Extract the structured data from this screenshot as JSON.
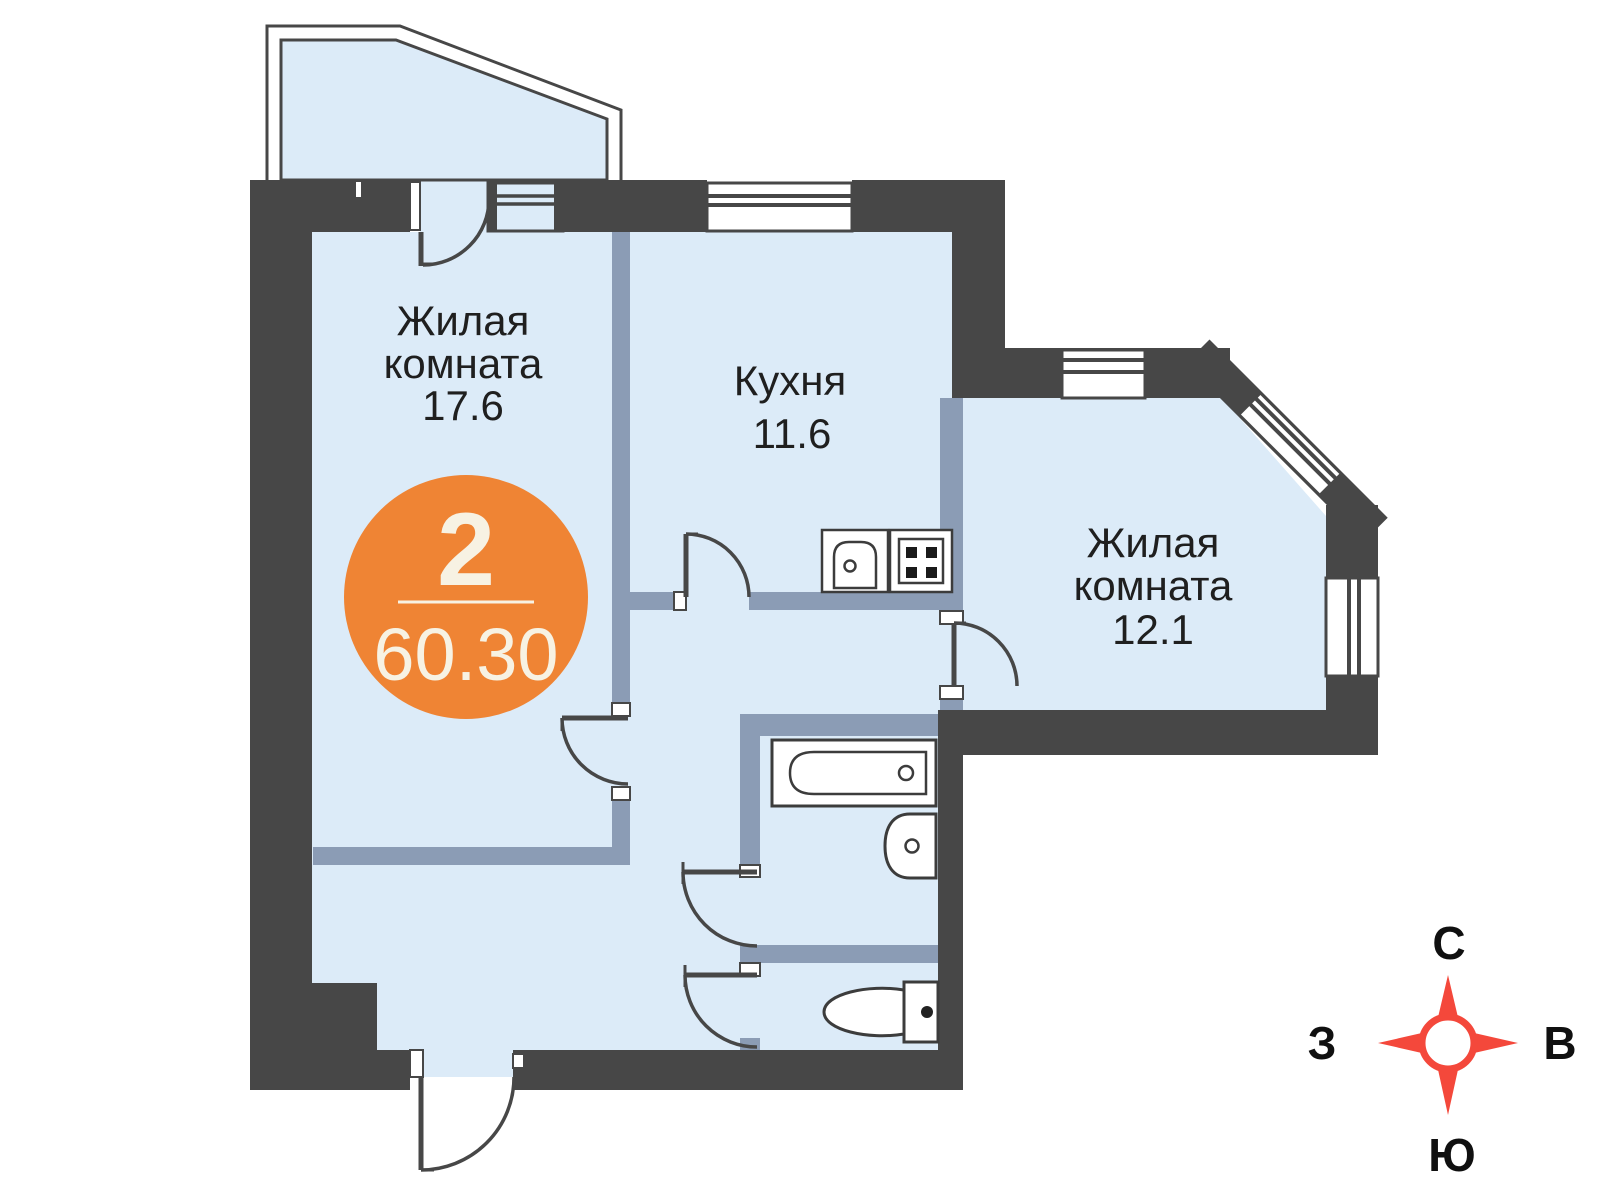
{
  "plan": {
    "badge": {
      "room_count": "2",
      "total_area": "60.30"
    },
    "rooms": [
      {
        "name_lines": [
          "Жилая",
          "комната"
        ],
        "area": "17.6"
      },
      {
        "name_lines": [
          "Кухня"
        ],
        "area": "11.6"
      },
      {
        "name_lines": [
          "Жилая",
          "комната"
        ],
        "area": "12.1"
      }
    ],
    "compass": {
      "north": "С",
      "east": "В",
      "south": "Ю",
      "west": "З"
    },
    "colors": {
      "wall": "#474747",
      "partition": "#8b9cb5",
      "floor": "#dcebf8",
      "accent": "#ef8434",
      "badge_text": "#f7f2e3",
      "compass": "#f4483b",
      "label": "#1f1f1f",
      "fixture": "#3c3c3c"
    }
  }
}
